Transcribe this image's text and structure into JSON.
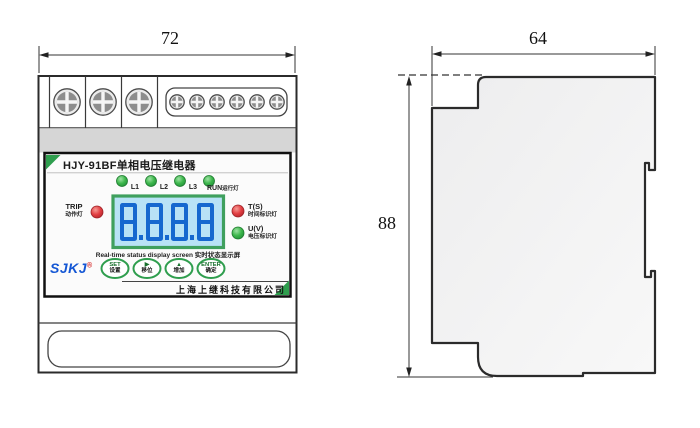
{
  "drawing": {
    "front_view": {
      "width_label": "72",
      "panel": {
        "title": "HJY-91BF单相电压继电器",
        "led_row": [
          {
            "label": "L1"
          },
          {
            "label": "L2"
          },
          {
            "label": "L3"
          },
          {
            "label": "RUN",
            "suffix": "运行灯"
          }
        ],
        "trip_led": {
          "en": "TRIP",
          "zh": "动作灯"
        },
        "time_led": {
          "en": "T(S)",
          "zh": "时间标识灯"
        },
        "voltage_led": {
          "en": "U(V)",
          "zh": "电压标识灯"
        },
        "display_value": "8.8.8.8",
        "screen_caption": "Real-time status display screen 实时状态显示屏",
        "brand": {
          "logo": "SJKJ",
          "reg": "®"
        },
        "buttons": [
          {
            "symbol": "SET",
            "label": "设置"
          },
          {
            "symbol": "▶",
            "label": "移位"
          },
          {
            "symbol": "▲",
            "label": "增加"
          },
          {
            "symbol": "ENTER",
            "label": "确定"
          }
        ],
        "company": "上海上继科技有限公司"
      }
    },
    "side_view": {
      "width_label": "64",
      "height_label": "88"
    },
    "colors": {
      "outline": "#2b2b2b",
      "led_green": "#3cb64b",
      "led_red": "#e23e42",
      "panel_green": "#2f9e4e",
      "lcd_frame": "#3fa05e",
      "lcd_bg": "#b8e2f6",
      "lcd_digit": "#1668cf",
      "logo_blue": "#1356d4"
    }
  }
}
